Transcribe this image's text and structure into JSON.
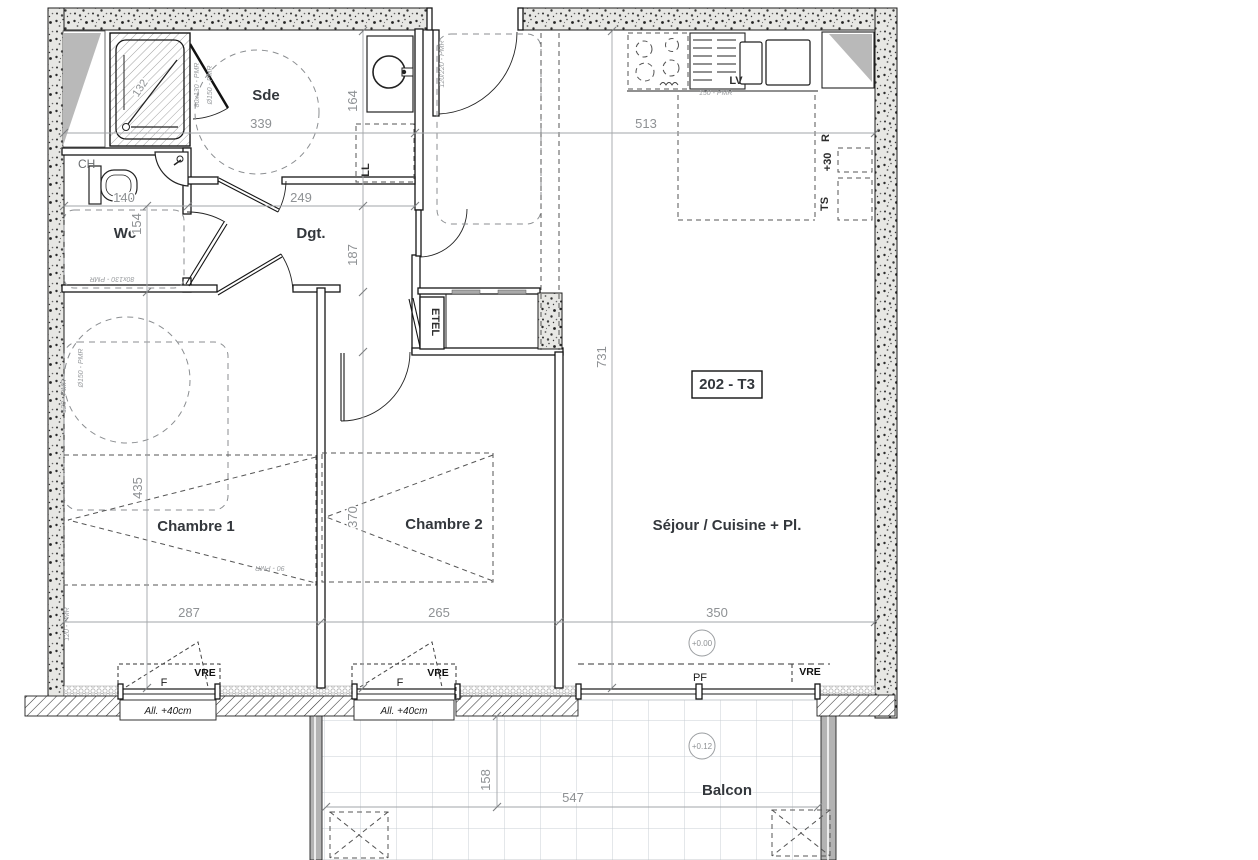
{
  "plan": {
    "unit_label": "202 - T3"
  },
  "rooms": {
    "sde": "Sde",
    "ch": "CH",
    "wc": "Wc",
    "dgt": "Dgt.",
    "chambre1": "Chambre 1",
    "chambre2": "Chambre 2",
    "sejour": "Séjour / Cuisine + Pl.",
    "balcon": "Balcon"
  },
  "equipment": {
    "ll": "LL",
    "lv": "LV",
    "etel": "ETEL",
    "ts": "TS",
    "plus30": "+30",
    "r": "R"
  },
  "windows": {
    "f": "F",
    "pf": "PF",
    "vre": "VRE",
    "allege": "All. +40cm"
  },
  "dimensions": {
    "sde_width": "339",
    "entree_depth": "164",
    "dgt_width": "249",
    "dgt_depth": "187",
    "wc_depth": "154",
    "wc_width": "140",
    "cuisine_width": "513",
    "sejour_depth": "731",
    "chambre1_depth": "435",
    "chambre2_depth": "370",
    "chambre1_width": "287",
    "chambre2_width": "265",
    "sejour_width": "350",
    "balcon_depth": "158",
    "balcon_width": "547",
    "douche_diag": "132"
  },
  "levels": {
    "interieur": "+0.00",
    "balcon": "+0.12"
  },
  "accessibility": {
    "turning_circle": "Ø150 - PMR",
    "door_entry": "120/220 - PMR",
    "wc_zone": "80x130 - PMR",
    "kitchen_zone": "150 - PMR",
    "bed_zone": "90 - PMR",
    "corridor_zone": "120 - PMR"
  }
}
